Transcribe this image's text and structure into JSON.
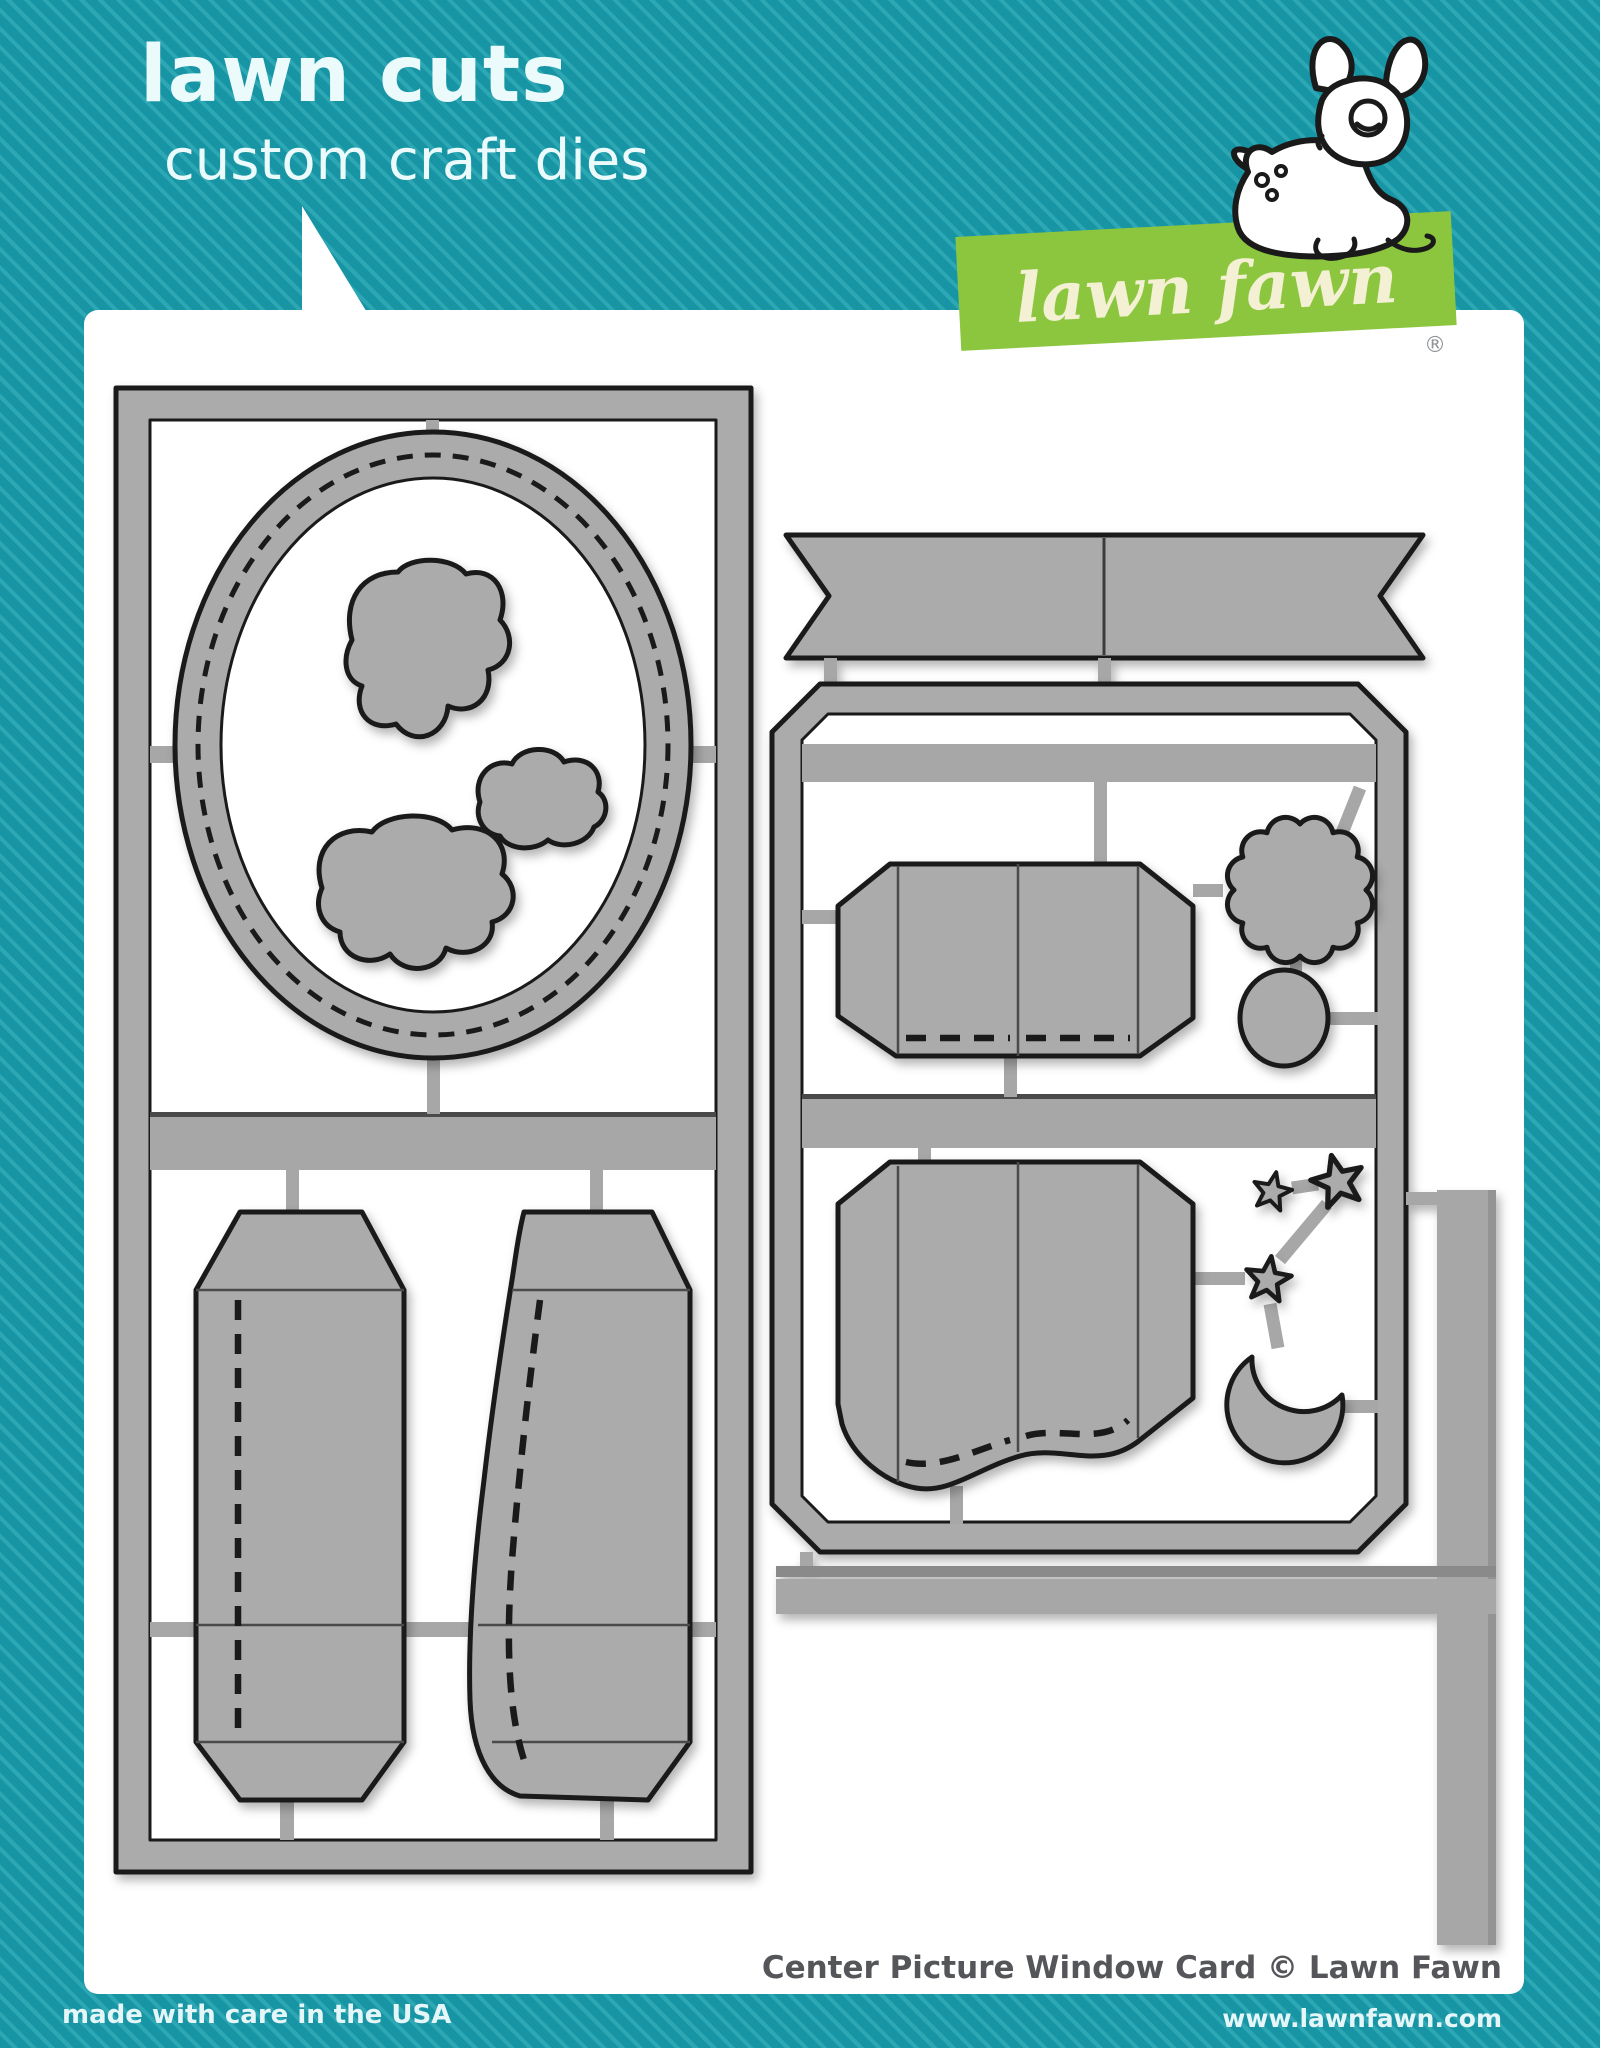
{
  "header": {
    "title": "lawn cuts",
    "subtitle": "custom craft dies"
  },
  "logo": {
    "brand": "lawn fawn",
    "registered": "®"
  },
  "footer": {
    "made_in": "made with care in the USA",
    "product": "Center Picture Window Card © Lawn Fawn",
    "website": "www.lawnfawn.com"
  },
  "dies": {
    "description": "gray steel craft die shapes on sprue frames",
    "shapes": [
      "stitched-oval-frame",
      "cloud-large",
      "cloud-small",
      "cloud-medium",
      "tall-card-base",
      "wavy-card-base",
      "banner-flag",
      "picture-window-card",
      "picture-window-card-wavy",
      "starburst-circle",
      "circle",
      "stars",
      "crescent-moon",
      "border-strips"
    ]
  },
  "colors": {
    "teal": "#1795a4",
    "teal_stripe": "#2ca7b3",
    "panel": "#ffffff",
    "die_fill": "#ababab",
    "connector": "#a7a7a7",
    "outline": "#1a1a1a",
    "logo_green": "#8cc63e",
    "logo_text": "#f4f0d4",
    "title_text": "#ebfbfb",
    "product_text": "#55565a",
    "footer_text": "#e4f6f7",
    "registered": "#8f9496"
  }
}
